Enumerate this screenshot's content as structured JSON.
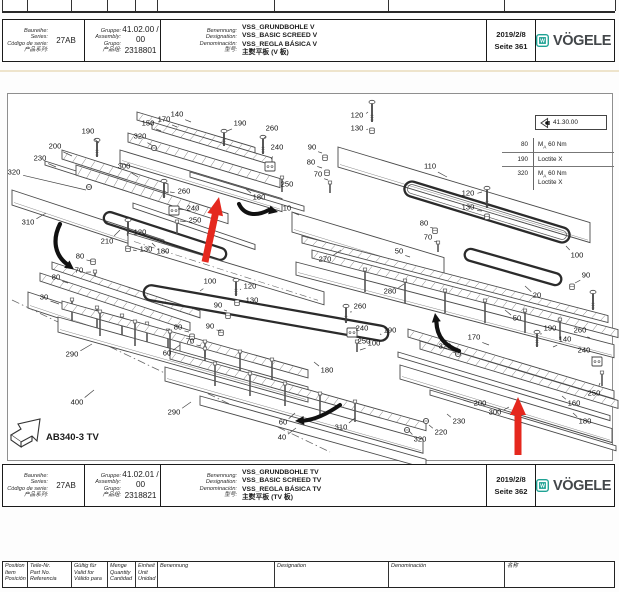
{
  "headers": [
    {
      "series_labels": [
        "Baureihe:",
        "Series:",
        "Código de serie:",
        "产品系列:"
      ],
      "series_value": "27AB",
      "group_labels": [
        "Gruppe:",
        "Assembly:",
        "Grupo:",
        "产品组:"
      ],
      "assembly_no": "41.02.00 / 00",
      "group_no": "2318801",
      "name_labels": [
        "Benennung:",
        "Designation:",
        "Denominación:",
        "型号:"
      ],
      "name_values": [
        "VSS_GRUNDBOHLE V",
        "VSS_BASIC SCREED V",
        "VSS_REGLA BÁSICA V",
        "主熨平板 (V 板)"
      ],
      "date": "2019/2/8",
      "page": "Seite 361",
      "brand": "VÖGELE",
      "logo_letter": "W"
    },
    {
      "series_labels": [
        "Baureihe:",
        "Series:",
        "Código de serie:",
        "产品系列:"
      ],
      "series_value": "27AB",
      "group_labels": [
        "Gruppe:",
        "Assembly:",
        "Grupo:",
        "产品组:"
      ],
      "assembly_no": "41.02.01 / 00",
      "group_no": "2318821",
      "name_labels": [
        "Benennung:",
        "Designation:",
        "Denominación:",
        "型号:"
      ],
      "name_values": [
        "VSS_GRUNDBOHLE TV",
        "VSS_BASIC SCREED TV",
        "VSS_REGLA BÁSICA TV",
        "主熨平板 (TV 板)"
      ],
      "date": "2019/2/8",
      "page": "Seite 362",
      "brand": "VÖGELE",
      "logo_letter": "W"
    }
  ],
  "legend": {
    "ref": "41.30.00",
    "rows": [
      {
        "pos": "80",
        "spec": [
          "MA 60 Nm"
        ]
      },
      {
        "pos": "190",
        "spec": [
          "Loctite X"
        ]
      },
      {
        "pos": "320",
        "spec": [
          "MA 60 Nm",
          "Loctite X"
        ]
      }
    ]
  },
  "model_label": "AB340-3 TV",
  "footer": {
    "columns": [
      [
        "Position",
        "Item",
        "Posición"
      ],
      [
        "Teile-Nr.",
        "Part No.",
        "Referencia"
      ],
      [
        "Gültig für",
        "Valid for",
        "Válido para"
      ],
      [
        "Menge",
        "Quantity",
        "Cantidad"
      ],
      [
        "Einheit",
        "Unit",
        "Unidad"
      ],
      [
        "Benennung"
      ],
      [
        "Designation"
      ],
      [
        "Denominación"
      ],
      [
        "名称"
      ]
    ]
  },
  "colors": {
    "brand_teal": "#1fa294",
    "red_arrow": "#e5281e"
  },
  "diagram": {
    "callouts": [
      {
        "t": "190",
        "x": 88,
        "y": 131,
        "ex": 99,
        "ey": 143
      },
      {
        "t": "200",
        "x": 55,
        "y": 146,
        "ex": 72,
        "ey": 156
      },
      {
        "t": "230",
        "x": 40,
        "y": 158,
        "ex": 56,
        "ey": 167
      },
      {
        "t": "320",
        "x": 14,
        "y": 172,
        "ex": 86,
        "ey": 190
      },
      {
        "t": "300",
        "x": 124,
        "y": 166,
        "ex": 138,
        "ey": 177
      },
      {
        "t": "260",
        "x": 184,
        "y": 191,
        "ex": 170,
        "ey": 192
      },
      {
        "t": "240",
        "x": 193,
        "y": 208,
        "ex": 178,
        "ey": 209
      },
      {
        "t": "250",
        "x": 195,
        "y": 220,
        "ex": 180,
        "ey": 221
      },
      {
        "t": "310",
        "x": 28,
        "y": 222,
        "ex": 46,
        "ey": 213
      },
      {
        "t": "210",
        "x": 107,
        "y": 241,
        "ex": 120,
        "ey": 230
      },
      {
        "t": "120",
        "x": 140,
        "y": 232,
        "ex": 131,
        "ey": 230
      },
      {
        "t": "130",
        "x": 146,
        "y": 249,
        "ex": 133,
        "ey": 250
      },
      {
        "t": "180",
        "x": 163,
        "y": 251,
        "ex": 152,
        "ey": 243
      },
      {
        "t": "80",
        "x": 80,
        "y": 256,
        "ex": 91,
        "ey": 261
      },
      {
        "t": "150",
        "x": 148,
        "y": 123,
        "ex": 161,
        "ey": 131
      },
      {
        "t": "170",
        "x": 164,
        "y": 119,
        "ex": 177,
        "ey": 127
      },
      {
        "t": "140",
        "x": 177,
        "y": 114,
        "ex": 191,
        "ey": 122
      },
      {
        "t": "320",
        "x": 140,
        "y": 136,
        "ex": 153,
        "ey": 146
      },
      {
        "t": "190",
        "x": 240,
        "y": 123,
        "ex": 227,
        "ey": 131
      },
      {
        "t": "260",
        "x": 272,
        "y": 128,
        "ex": 264,
        "ey": 138
      },
      {
        "t": "240",
        "x": 277,
        "y": 147,
        "ex": 271,
        "ey": 159
      },
      {
        "t": "250",
        "x": 287,
        "y": 184,
        "ex": 283,
        "ey": 177
      },
      {
        "t": "180",
        "x": 259,
        "y": 197,
        "ex": 246,
        "ey": 189
      },
      {
        "t": "10",
        "x": 287,
        "y": 208,
        "ex": 299,
        "ey": 215
      },
      {
        "t": "120",
        "x": 357,
        "y": 115,
        "ex": 368,
        "ey": 112
      },
      {
        "t": "130",
        "x": 357,
        "y": 128,
        "ex": 368,
        "ey": 129
      },
      {
        "t": "90",
        "x": 312,
        "y": 147,
        "ex": 322,
        "ey": 153
      },
      {
        "t": "80",
        "x": 311,
        "y": 162,
        "ex": 322,
        "ey": 168
      },
      {
        "t": "70",
        "x": 318,
        "y": 174,
        "ex": 328,
        "ey": 180
      },
      {
        "t": "110",
        "x": 430,
        "y": 166,
        "ex": 447,
        "ey": 177
      },
      {
        "t": "120",
        "x": 468,
        "y": 193,
        "ex": 482,
        "ey": 192
      },
      {
        "t": "130",
        "x": 468,
        "y": 207,
        "ex": 482,
        "ey": 211
      },
      {
        "t": "100",
        "x": 577,
        "y": 255,
        "ex": 566,
        "ey": 246
      },
      {
        "t": "80",
        "x": 424,
        "y": 223,
        "ex": 433,
        "ey": 228
      },
      {
        "t": "70",
        "x": 428,
        "y": 237,
        "ex": 437,
        "ey": 242
      },
      {
        "t": "50",
        "x": 399,
        "y": 251,
        "ex": 410,
        "ey": 257
      },
      {
        "t": "20",
        "x": 537,
        "y": 295,
        "ex": 525,
        "ey": 286
      },
      {
        "t": "50",
        "x": 517,
        "y": 318,
        "ex": 505,
        "ey": 310
      },
      {
        "t": "90",
        "x": 586,
        "y": 275,
        "ex": 575,
        "ey": 283
      },
      {
        "t": "270",
        "x": 325,
        "y": 259,
        "ex": 341,
        "ey": 250
      },
      {
        "t": "280",
        "x": 390,
        "y": 291,
        "ex": 404,
        "ey": 284
      },
      {
        "t": "70",
        "x": 79,
        "y": 270,
        "ex": 91,
        "ey": 272
      },
      {
        "t": "80",
        "x": 56,
        "y": 277,
        "ex": 68,
        "ey": 283
      },
      {
        "t": "30",
        "x": 44,
        "y": 297,
        "ex": 59,
        "ey": 304
      },
      {
        "t": "290",
        "x": 72,
        "y": 354,
        "ex": 92,
        "ey": 344
      },
      {
        "t": "400",
        "x": 77,
        "y": 402,
        "ex": 94,
        "ey": 390
      },
      {
        "t": "60",
        "x": 167,
        "y": 353,
        "ex": 180,
        "ey": 345
      },
      {
        "t": "290",
        "x": 174,
        "y": 412,
        "ex": 191,
        "ey": 402
      },
      {
        "t": "100",
        "x": 210,
        "y": 281,
        "ex": 200,
        "ey": 291
      },
      {
        "t": "120",
        "x": 250,
        "y": 286,
        "ex": 240,
        "ey": 289
      },
      {
        "t": "130",
        "x": 252,
        "y": 300,
        "ex": 242,
        "ey": 301
      },
      {
        "t": "90",
        "x": 218,
        "y": 305,
        "ex": 227,
        "ey": 311
      },
      {
        "t": "90",
        "x": 210,
        "y": 326,
        "ex": 221,
        "ey": 331
      },
      {
        "t": "80",
        "x": 178,
        "y": 327,
        "ex": 189,
        "ey": 332
      },
      {
        "t": "70",
        "x": 190,
        "y": 341,
        "ex": 201,
        "ey": 346
      },
      {
        "t": "100",
        "x": 374,
        "y": 343,
        "ex": 360,
        "ey": 350
      },
      {
        "t": "260",
        "x": 360,
        "y": 306,
        "ex": 350,
        "ey": 312
      },
      {
        "t": "240",
        "x": 362,
        "y": 328,
        "ex": 353,
        "ey": 329
      },
      {
        "t": "250",
        "x": 364,
        "y": 341,
        "ex": 355,
        "ey": 342
      },
      {
        "t": "190",
        "x": 390,
        "y": 330,
        "ex": 380,
        "ey": 334
      },
      {
        "t": "180",
        "x": 327,
        "y": 370,
        "ex": 314,
        "ey": 362
      },
      {
        "t": "310",
        "x": 341,
        "y": 427,
        "ex": 355,
        "ey": 418
      },
      {
        "t": "60",
        "x": 283,
        "y": 422,
        "ex": 295,
        "ey": 413
      },
      {
        "t": "40",
        "x": 282,
        "y": 437,
        "ex": 296,
        "ey": 428
      },
      {
        "t": "190",
        "x": 550,
        "y": 328,
        "ex": 540,
        "ey": 334
      },
      {
        "t": "170",
        "x": 474,
        "y": 337,
        "ex": 489,
        "ey": 345
      },
      {
        "t": "140",
        "x": 565,
        "y": 339,
        "ex": 553,
        "ey": 347
      },
      {
        "t": "260",
        "x": 580,
        "y": 330,
        "ex": 590,
        "ey": 338
      },
      {
        "t": "240",
        "x": 584,
        "y": 350,
        "ex": 593,
        "ey": 357
      },
      {
        "t": "250",
        "x": 594,
        "y": 393,
        "ex": 600,
        "ey": 383
      },
      {
        "t": "320",
        "x": 445,
        "y": 346,
        "ex": 456,
        "ey": 353
      },
      {
        "t": "200",
        "x": 480,
        "y": 403,
        "ex": 463,
        "ey": 400
      },
      {
        "t": "300",
        "x": 495,
        "y": 412,
        "ex": 509,
        "ey": 407
      },
      {
        "t": "160",
        "x": 574,
        "y": 403,
        "ex": 562,
        "ey": 396
      },
      {
        "t": "180",
        "x": 585,
        "y": 421,
        "ex": 573,
        "ey": 413
      },
      {
        "t": "230",
        "x": 459,
        "y": 421,
        "ex": 447,
        "ey": 414
      },
      {
        "t": "220",
        "x": 441,
        "y": 432,
        "ex": 429,
        "ey": 425
      },
      {
        "t": "320",
        "x": 420,
        "y": 439,
        "ex": 409,
        "ey": 431
      }
    ]
  }
}
